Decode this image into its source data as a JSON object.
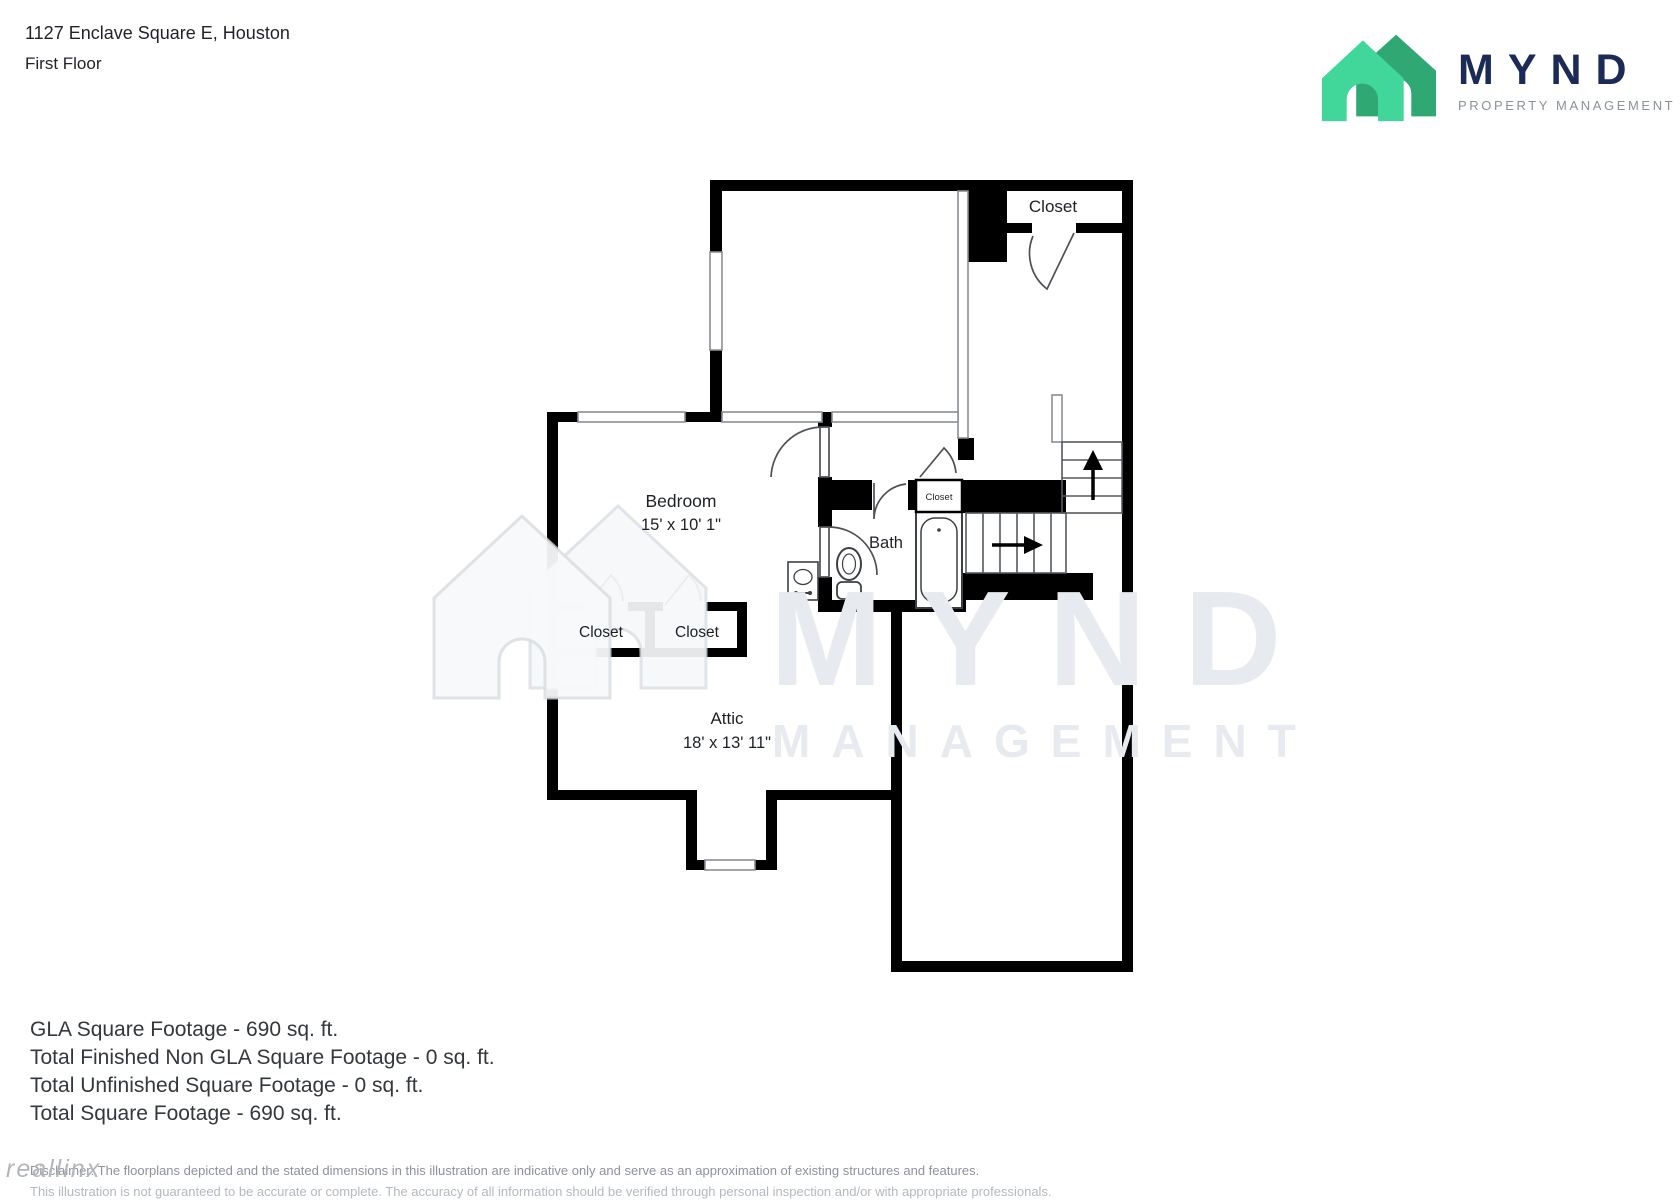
{
  "header": {
    "address": "1127 Enclave Square E, Houston",
    "floor": "First Floor"
  },
  "logo": {
    "brand": "MYND",
    "tagline": "PROPERTY MANAGEMENT",
    "house_light_color": "#41d79b",
    "house_dark_color": "#2fa873",
    "brand_color": "#1b2a56"
  },
  "plan": {
    "closet_top_right": "Closet",
    "bedroom_name": "Bedroom",
    "bedroom_dims": "15' x 10' 1\"",
    "bath_name": "Bath",
    "bath_closet": "Closet",
    "closet_left": "Closet",
    "closet_right": "Closet",
    "attic_name": "Attic",
    "attic_dims": "18' x 13' 11\""
  },
  "watermark": {
    "line1": "MYND",
    "line2": "MANAGEMENT",
    "vendor": "reallinx"
  },
  "footer": {
    "lines": [
      "GLA Square Footage - 690 sq. ft.",
      "Total Finished Non GLA Square Footage - 0 sq. ft.",
      "Total Unfinished Square Footage - 0 sq. ft.",
      "Total Square Footage - 690 sq. ft."
    ]
  },
  "disclaimer": {
    "line1": "Disclaimer: The floorplans depicted and the stated dimensions in this illustration are indicative only and serve as an approximation of existing structures and features.",
    "line2": "This illustration is not guaranteed to be accurate or complete. The accuracy of all information should be verified through personal inspection and/or with appropriate professionals."
  }
}
